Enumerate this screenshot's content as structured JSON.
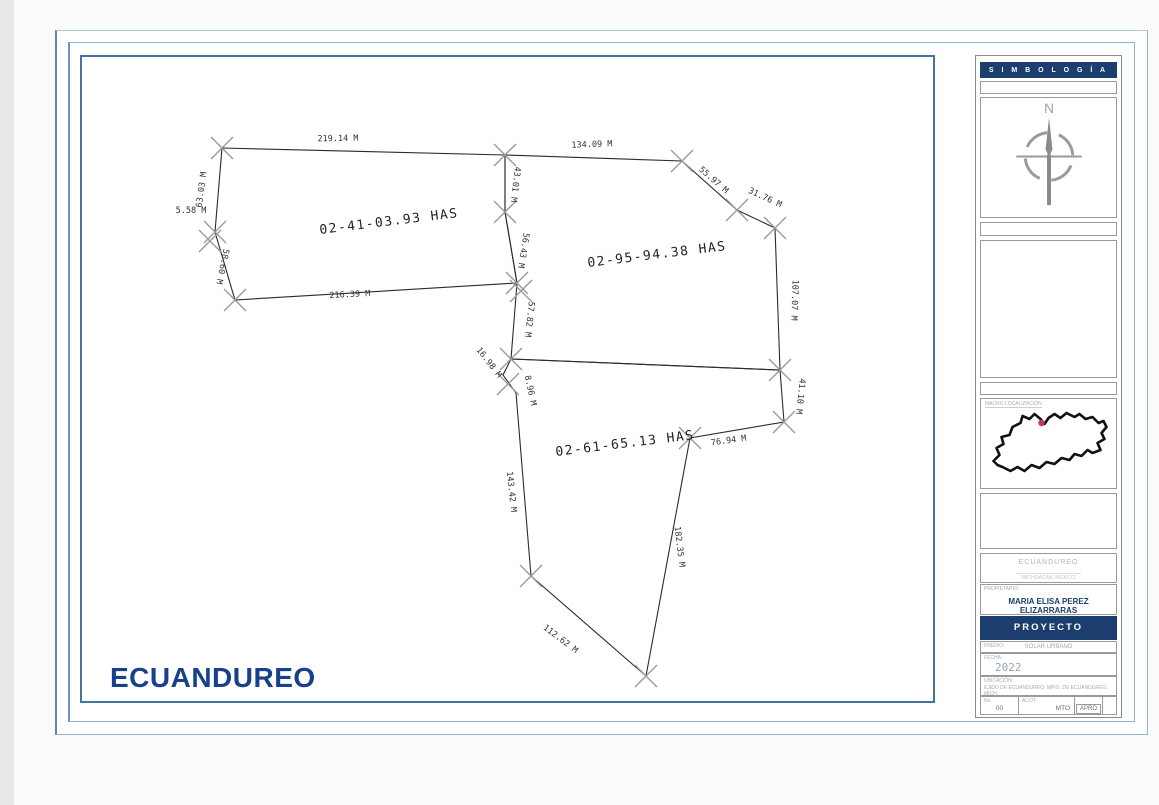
{
  "page": {
    "location_title": "ECUANDUREO"
  },
  "drawing": {
    "parcels": [
      {
        "label": "02-41-03.93 HAS"
      },
      {
        "label": "02-95-94.38 HAS"
      },
      {
        "label": "02-61-65.13 HAS"
      }
    ],
    "measurements": [
      {
        "text": "219.14 M"
      },
      {
        "text": "63.03 M"
      },
      {
        "text": "5.58 M"
      },
      {
        "text": "58.60 M"
      },
      {
        "text": "216.39 M"
      },
      {
        "text": "43.01 M"
      },
      {
        "text": "56.43 M"
      },
      {
        "text": "57.82 M"
      },
      {
        "text": "134.09 M"
      },
      {
        "text": "55.97 M"
      },
      {
        "text": "31.76 M"
      },
      {
        "text": "107.07 M"
      },
      {
        "text": "41.10 M"
      },
      {
        "text": "76.94 M"
      },
      {
        "text": "182.35 M"
      },
      {
        "text": "112.62 M"
      },
      {
        "text": "16.98 M"
      },
      {
        "text": "8.96 M"
      },
      {
        "text": "143.42 M"
      }
    ]
  },
  "sidebar": {
    "simbologia_title": "S I M B O L O G Í A",
    "north_label": "N",
    "map_caption": "MACRO LOCALIZACIÓN",
    "titleblock": {
      "org_name": "ECUANDUREO",
      "org_subtitle": "MICHOACÁN, MÉXICO",
      "owner_label": "PROPIETARIO:",
      "owner_name": "MARIA ELISA PEREZ ELIZARRARAS",
      "project_band": "PROYECTO",
      "predio_label": "PREDIO:",
      "predio_value": "SOLAR URBANO",
      "year_label": "FECHA:",
      "year_value": "2022",
      "location_label": "UBICACIÓN:",
      "location_value": "EJIDO DE ECUANDUREO, MPIO. DE ECUANDUREO, MICH.",
      "cells": [
        {
          "label": "No.",
          "value": "00"
        },
        {
          "label": "ACOT.",
          "value": "MTO"
        },
        {
          "label": "",
          "value": "APRO"
        },
        {
          "label": "",
          "value": ""
        }
      ]
    }
  },
  "colors": {
    "navy": "#1c3e6e",
    "title_blue": "#17418a",
    "frame_blue": "#46749e",
    "marker_red": "#c4365a"
  }
}
